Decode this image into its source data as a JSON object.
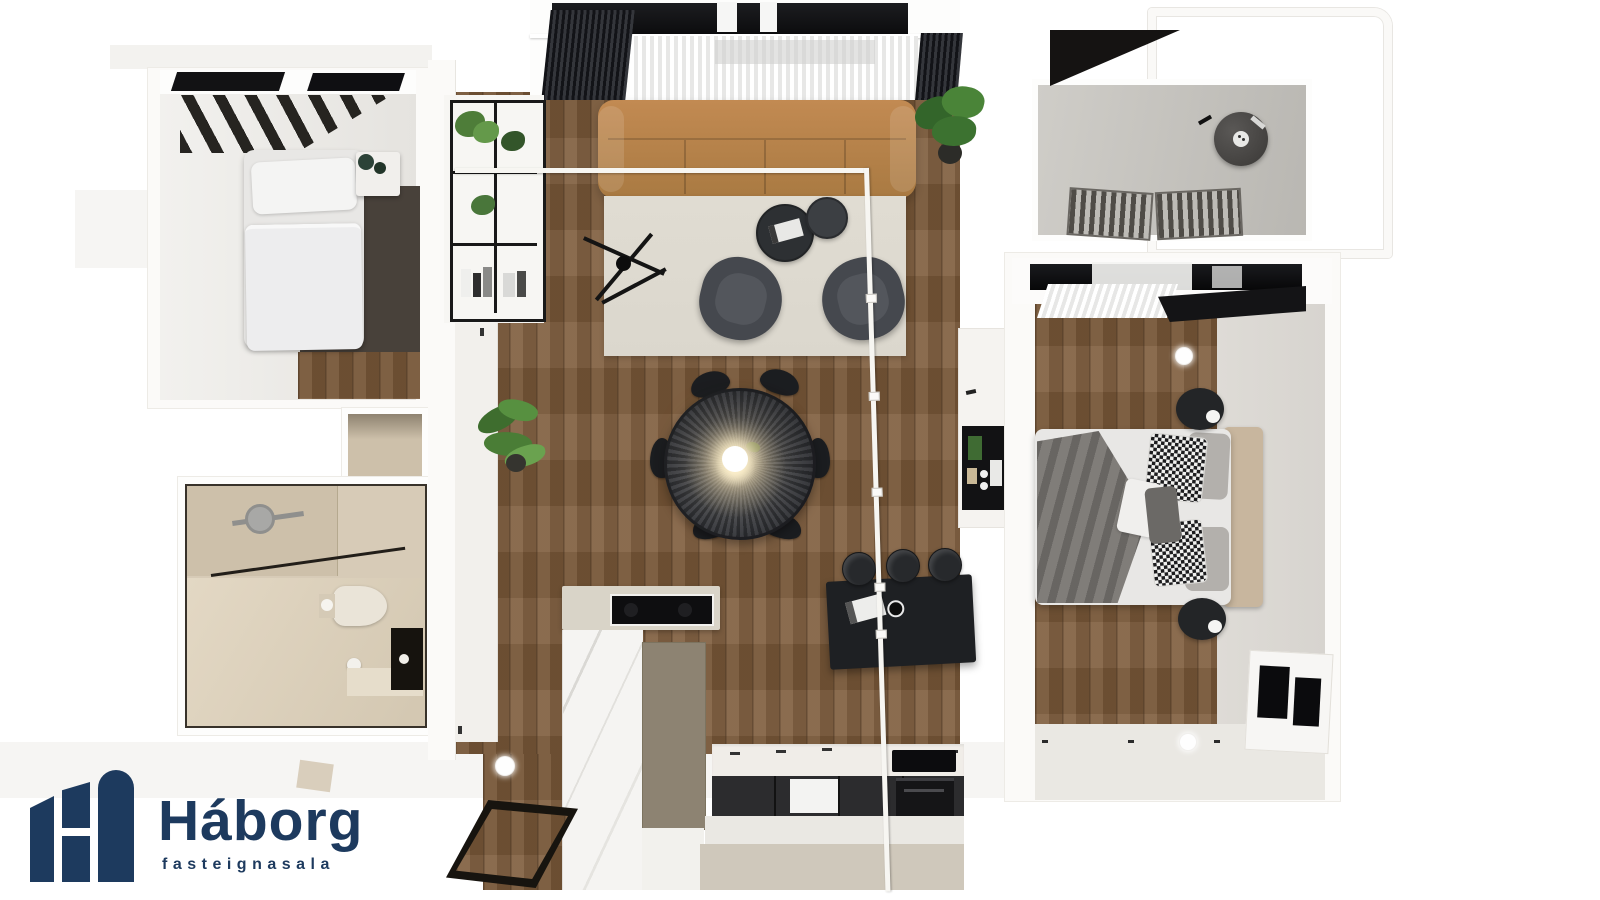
{
  "brand": {
    "name": "Háborg",
    "tagline": "fasteignasala"
  },
  "scene": {
    "type": "3d-apartment-floor-plan-top-view",
    "rooms": [
      "small-bedroom",
      "bathroom",
      "living-dining-kitchen",
      "hallway",
      "master-bedroom",
      "balcony"
    ]
  },
  "palette": {
    "background": "#ffffff",
    "navy": "#1d3a5e",
    "wall": "#fbfaf8",
    "wall_shadow": "#edebe6",
    "wood": "#7d5b3a",
    "carpet": "#48413a",
    "rug": "#dbd7cd",
    "sofa": "#c28a52",
    "sofa_dark": "#a97a42",
    "armchair": "#45484e",
    "table_dark": "#303236",
    "bar_black": "#1e2023",
    "island_marble": "#f5f4f2",
    "island_taupe": "#8d8372",
    "counter_white": "#f0ede8",
    "cabinet_dark": "#2c2c2e",
    "bath_tile": "#d7cbb7",
    "bath_tile_dark": "#cdc0aa",
    "concrete": "#c9c7c2",
    "bed_white": "#e8e7e5",
    "headboard": "#c8b69e",
    "throw_gray": "#807d79",
    "greige": "#cfc8bb",
    "floor_light": "#eae8e3",
    "gray_floor": "#d7d4cf",
    "glass_white": "#f7f6f2",
    "plant_green": "#4e7d39",
    "plant_green_dark": "#33552a"
  }
}
